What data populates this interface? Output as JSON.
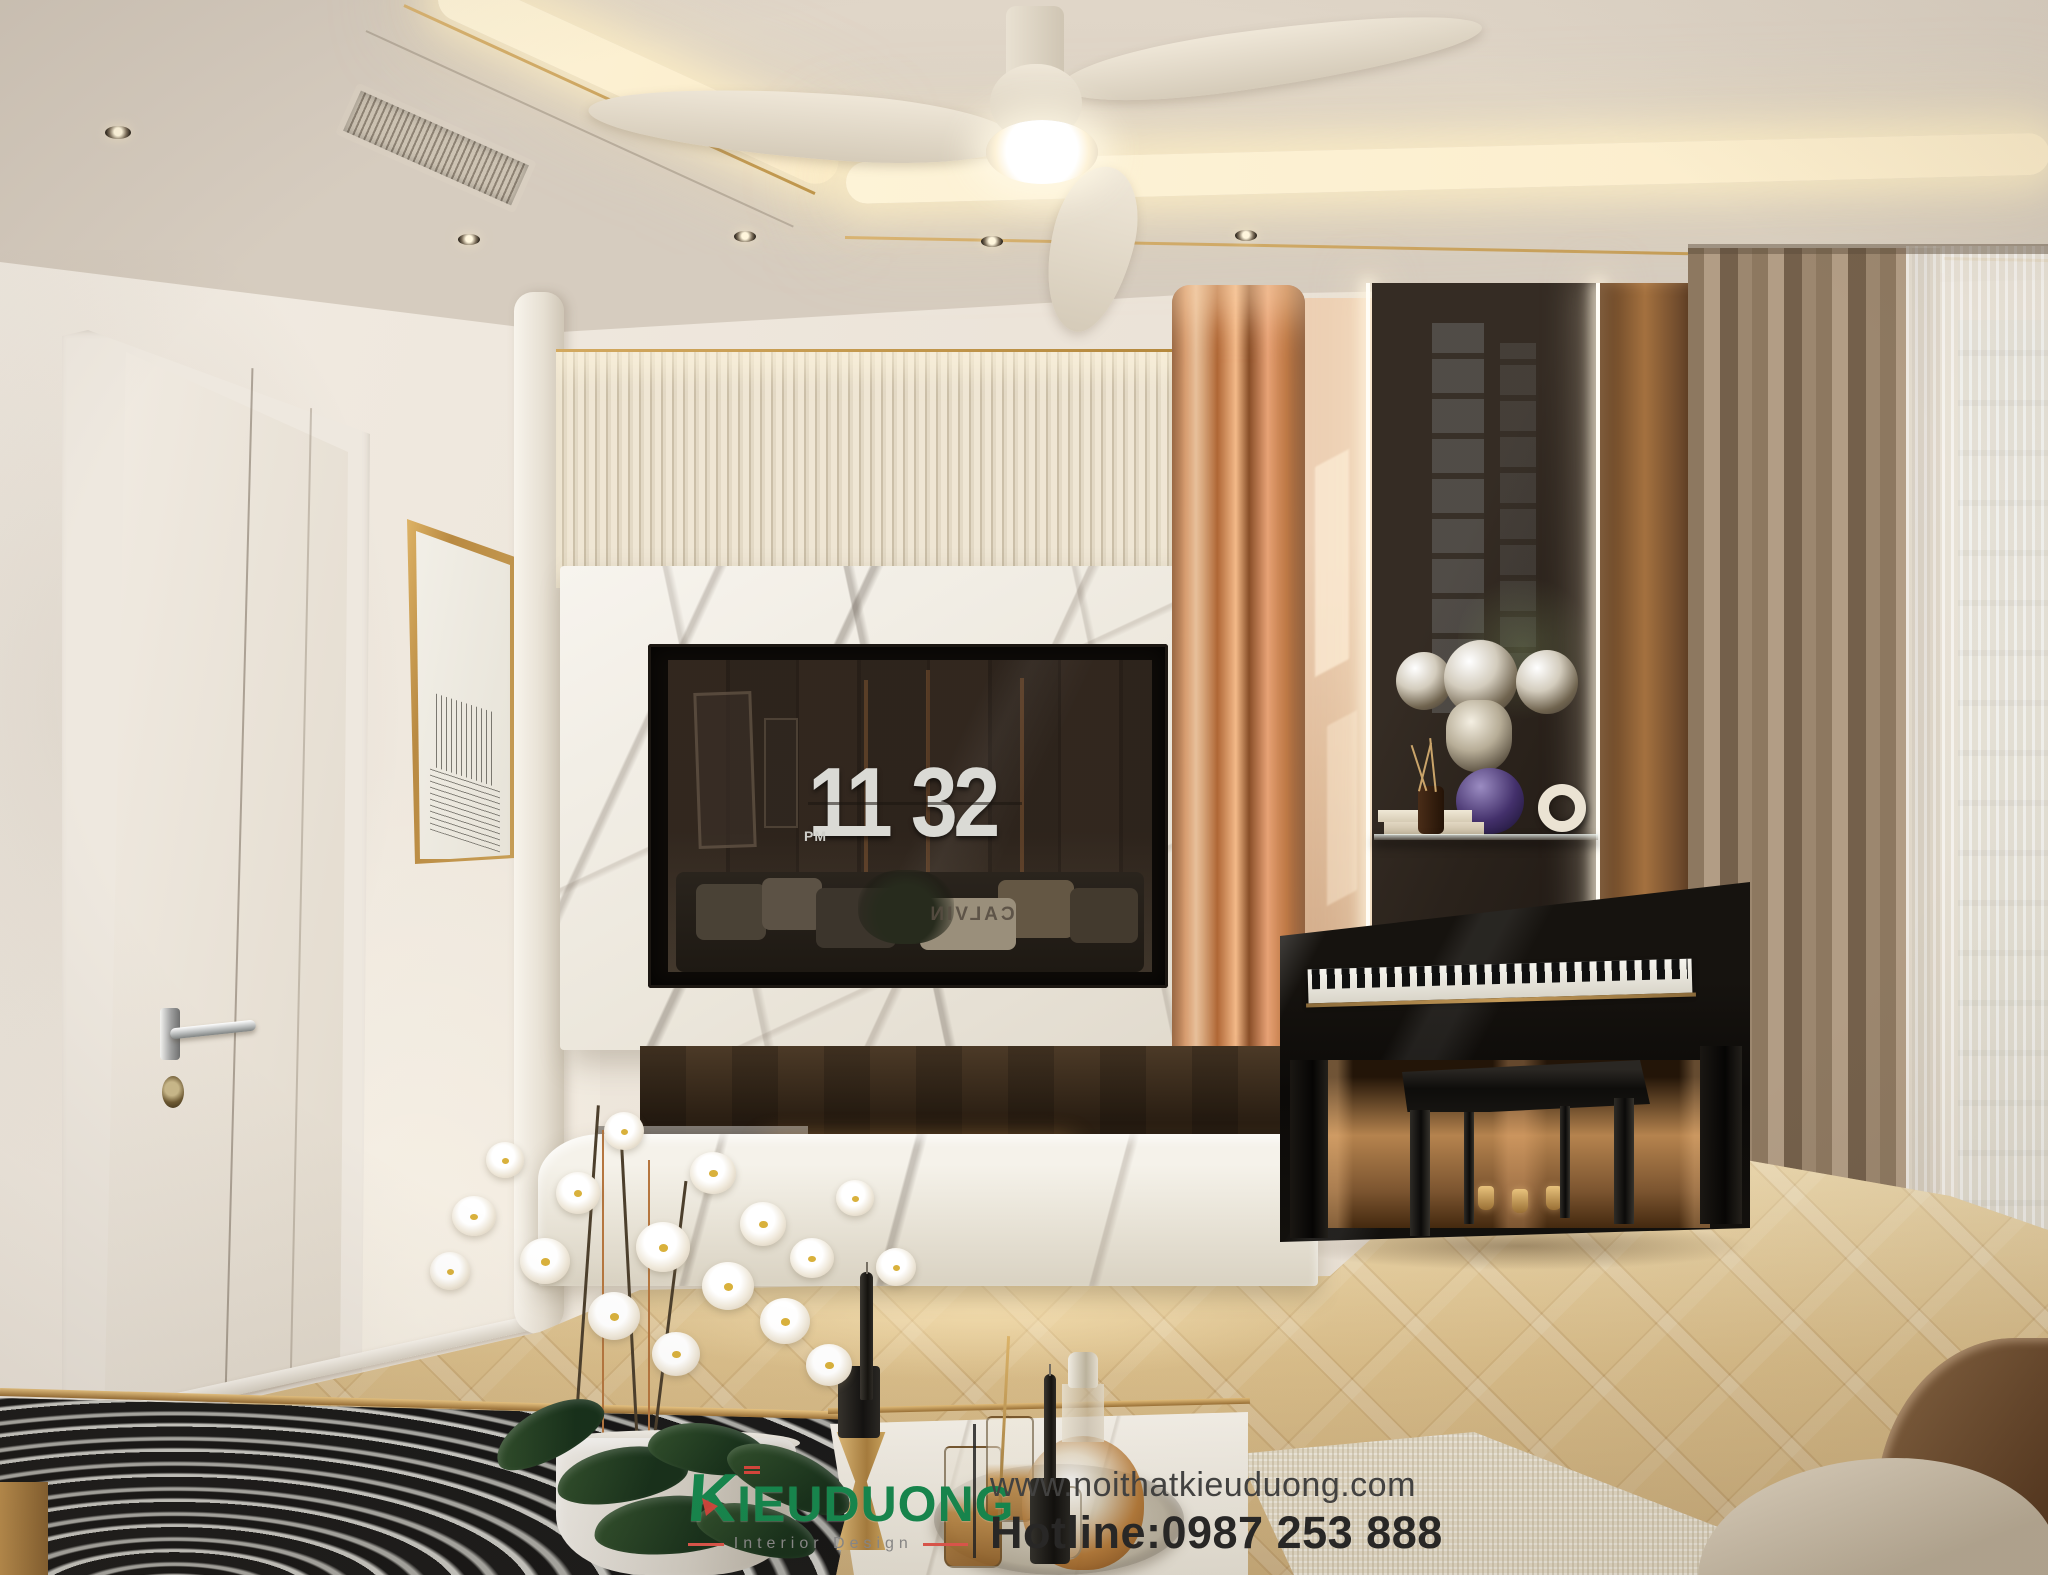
{
  "scene": {
    "description": "Modern luxury living room interior render",
    "width": 2048,
    "height": 1575
  },
  "clock": {
    "hour": "11",
    "minute": "32",
    "meridiem": "PM"
  },
  "tv": {
    "reflection_text": "CALVIN"
  },
  "watermark": {
    "brand_initial": "K",
    "brand_rest": "IEUDUONG",
    "tagline": "Interior Design",
    "website": "www.noithatkieuduong.com",
    "hotline": "Hotline:0987 253 888",
    "brand_color": "#14894e",
    "accent_color": "#e2564c",
    "hotline_color": "#262626"
  },
  "palette": {
    "ceiling": "#d6ccbf",
    "cove_light": "#fdf3d7",
    "gold_trim": "#c59a4e",
    "wall": "#efe8df",
    "slat_wall": "#e7ddca",
    "marble": "#f3f0e9",
    "copper": "#eaa877",
    "floor_oak": "#d9bf8e",
    "curtain": "#8d7860",
    "piano": "#12100d",
    "flame": "#ffb351",
    "orchid": "#ffffff"
  }
}
